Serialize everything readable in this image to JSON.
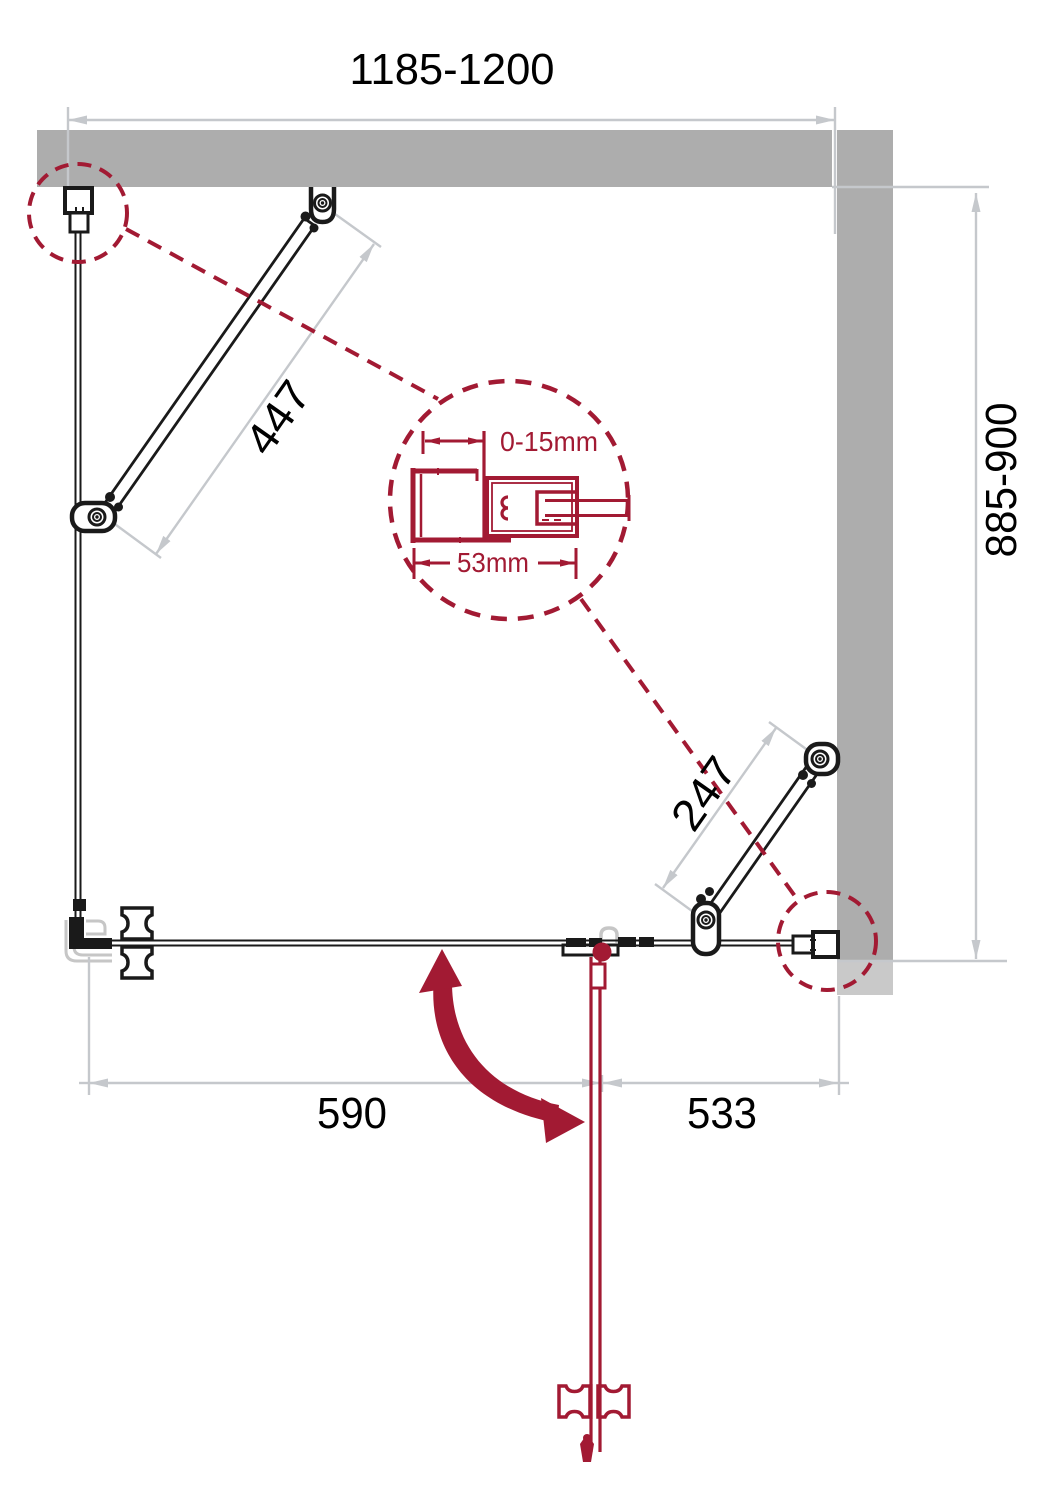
{
  "drawing": {
    "dimensions": {
      "top_width": "1185-1200",
      "right_depth": "885-900",
      "left_fold_panel": "447",
      "right_fold_panel": "247",
      "bottom_left": "590",
      "bottom_right": "533"
    },
    "detail": {
      "adjustment_range": "0-15mm",
      "profile_width": "53mm"
    },
    "colors": {
      "accent_red": "#A21A33",
      "wall_gray": "#ADADAD",
      "wall_gray_light": "#C9C9C9",
      "dimension_gray": "#C5C8CC",
      "line_black": "#1A1A1A"
    }
  }
}
